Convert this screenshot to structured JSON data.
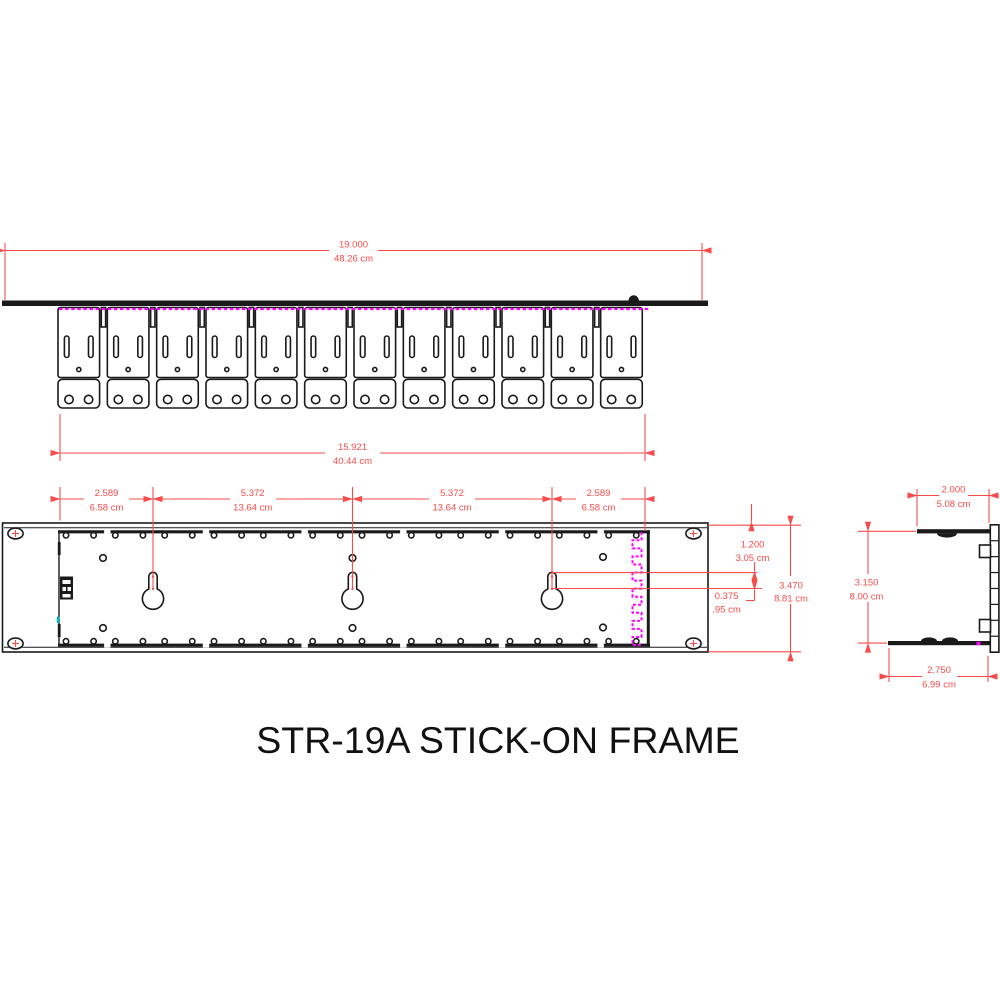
{
  "title": "STR-19A STICK-ON FRAME",
  "colors": {
    "dimension": "#f84b4b",
    "adhesive": "#ff00ff",
    "teal_mark": "#00b4bc",
    "outline": "#1a1a1a"
  },
  "top_view": {
    "bracket_count": 12,
    "dim_overall": {
      "in": "19.000",
      "cm": "48.26 cm"
    },
    "dim_mount": {
      "in": "15.921",
      "cm": "40.44 cm"
    }
  },
  "front_view": {
    "keyhole_count": 3,
    "dim_segments": [
      {
        "in": "2.589",
        "cm": "6.58 cm"
      },
      {
        "in": "5.372",
        "cm": "13.64 cm"
      },
      {
        "in": "5.372",
        "cm": "13.64 cm"
      },
      {
        "in": "2.589",
        "cm": "6.58 cm"
      }
    ],
    "dim_top_to_slot": {
      "in": "1.200",
      "cm": "3.05 cm"
    },
    "dim_slot_offset": {
      "in": "0.375",
      "cm": ".95 cm"
    },
    "dim_height": {
      "in": "3.470",
      "cm": "8.81 cm"
    }
  },
  "side_view": {
    "dim_top_flange": {
      "in": "2.000",
      "cm": "5.08 cm"
    },
    "dim_height": {
      "in": "3.150",
      "cm": "8.00 cm"
    },
    "dim_bottom_flange": {
      "in": "2.750",
      "cm": "6.99 cm"
    }
  }
}
